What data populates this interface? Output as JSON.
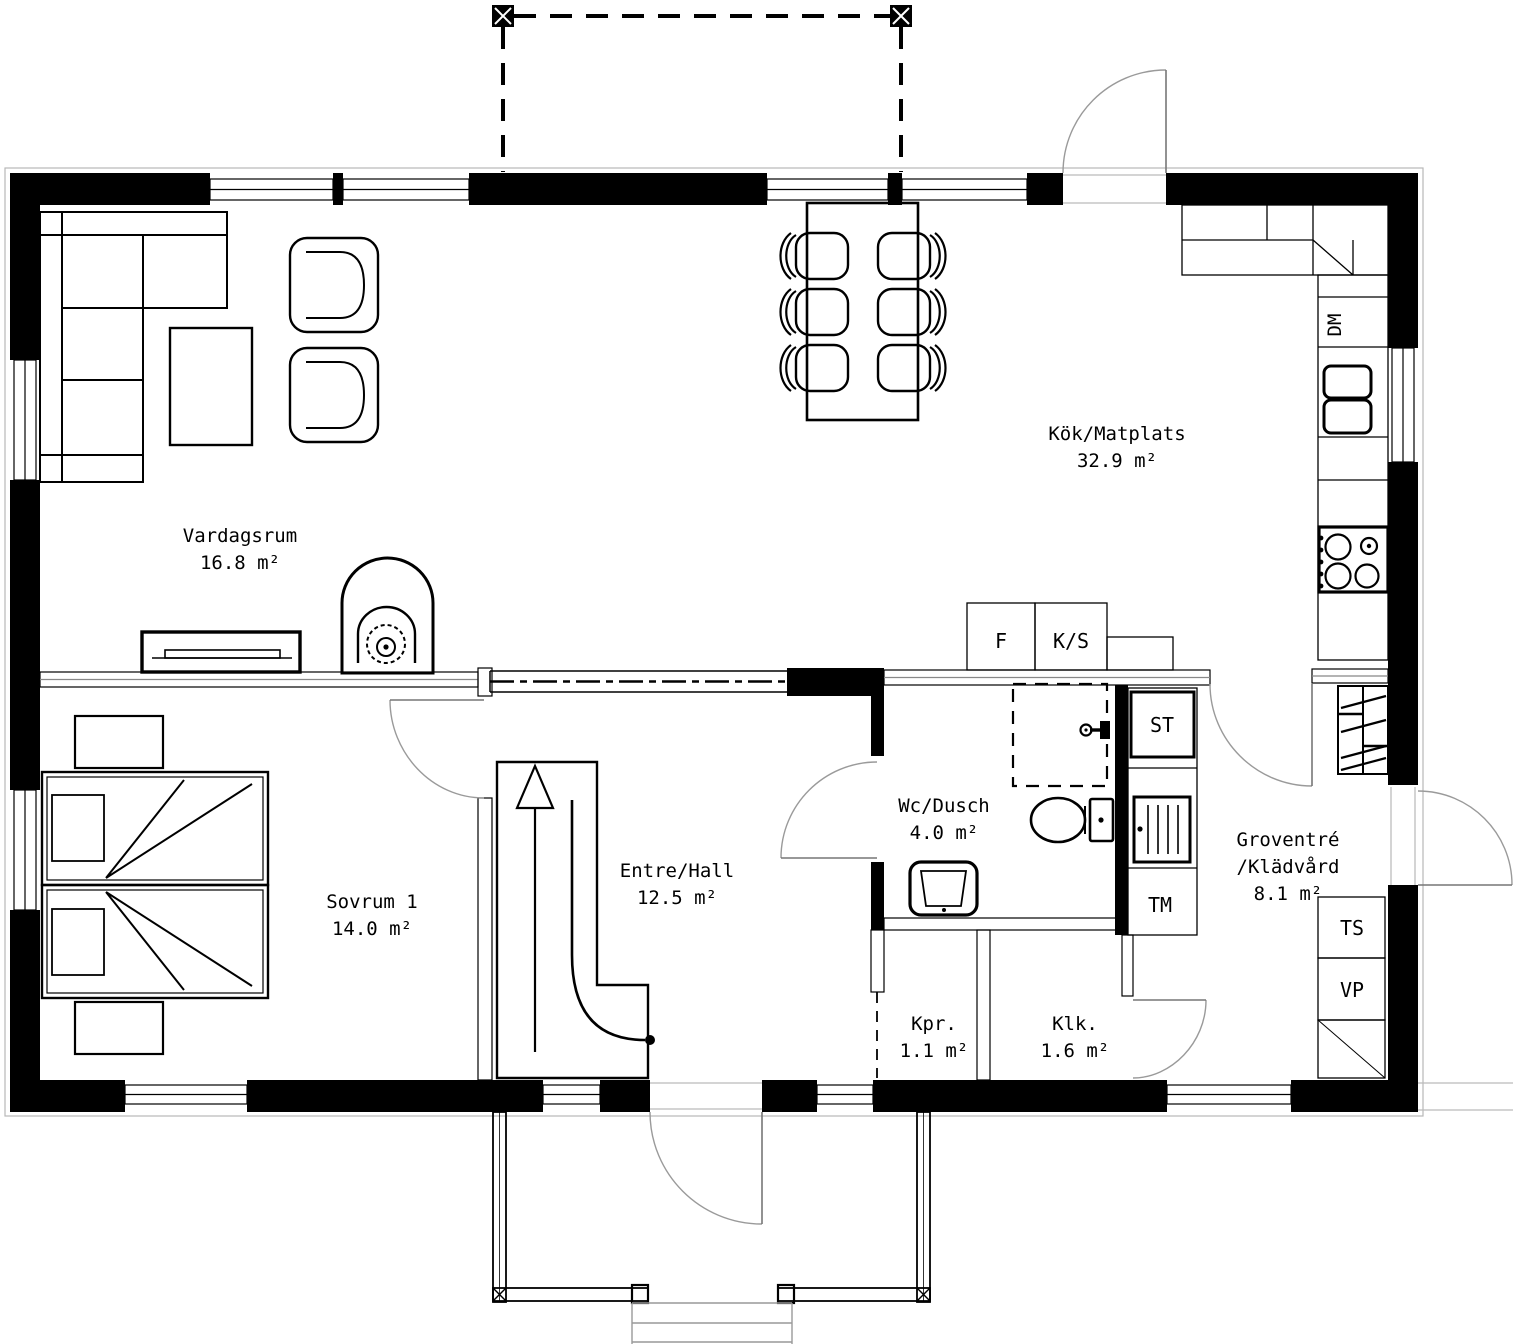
{
  "rooms": {
    "vardagsrum": {
      "name": "Vardagsrum",
      "area": "16.8 m²"
    },
    "kok_matplats": {
      "name": "Kök/Matplats",
      "area": "32.9 m²"
    },
    "sovrum_1": {
      "name": "Sovrum 1",
      "area": "14.0 m²"
    },
    "entre_hall": {
      "name": "Entre/Hall",
      "area": "12.5 m²"
    },
    "wc_dusch": {
      "name": "Wc/Dusch",
      "area": "4.0 m²"
    },
    "groventre": {
      "name": "Groventré",
      "name2": "/Klädvård",
      "area": "8.1 m²"
    },
    "kpr": {
      "name": "Kpr.",
      "area": "1.1 m²"
    },
    "klk": {
      "name": "Klk.",
      "area": "1.6 m²"
    }
  },
  "appliance_labels": {
    "fridge": "F",
    "freezer_pantry": "K/S",
    "dishwasher": "DM",
    "cleaning_cabinet": "ST",
    "washing_machine": "TM",
    "drying_cabinet": "TS",
    "heat_pump": "VP"
  },
  "colors": {
    "wall": "#000000",
    "background": "#ffffff",
    "door_swing": "#9a9a9a",
    "thin_line": "#000000"
  }
}
